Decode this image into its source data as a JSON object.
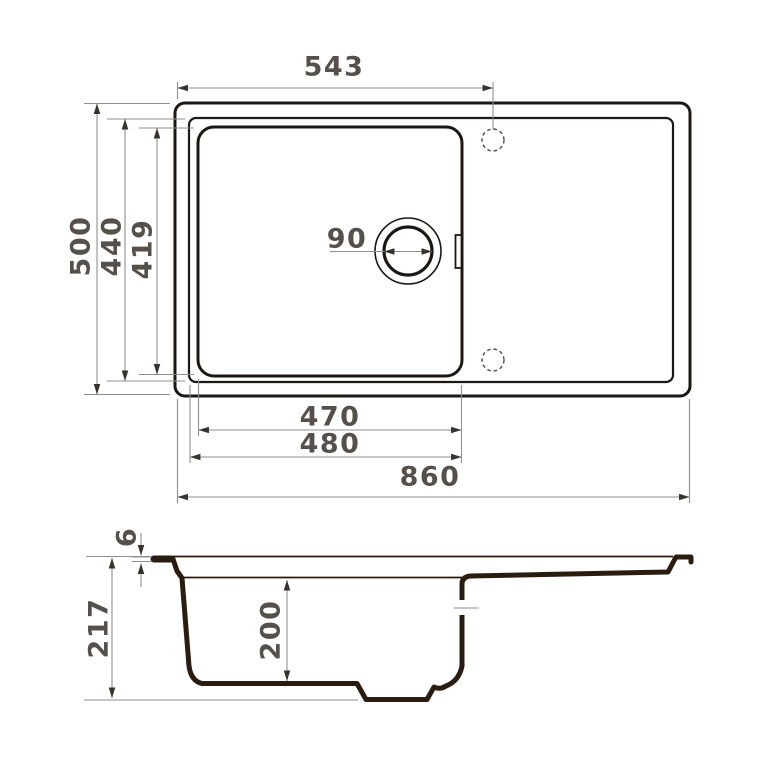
{
  "colors": {
    "ink": "#1d1713",
    "section": "#2b1c10",
    "dim": "#8f8f8f",
    "text": "#56504b",
    "arrow": "#38322c",
    "bg": "#ffffff"
  },
  "top_view": {
    "dim_faucet_offset": "543",
    "dim_overall_depth": "500",
    "dim_rim_depth": "440",
    "dim_bowl_depth": "419",
    "dim_drain_diameter": "90",
    "dim_bowl_width": "470",
    "dim_rim_width": "480",
    "dim_overall_width": "860"
  },
  "side_view": {
    "dim_rim_thickness": "6",
    "dim_overall_height": "217",
    "dim_bowl_height": "200"
  }
}
